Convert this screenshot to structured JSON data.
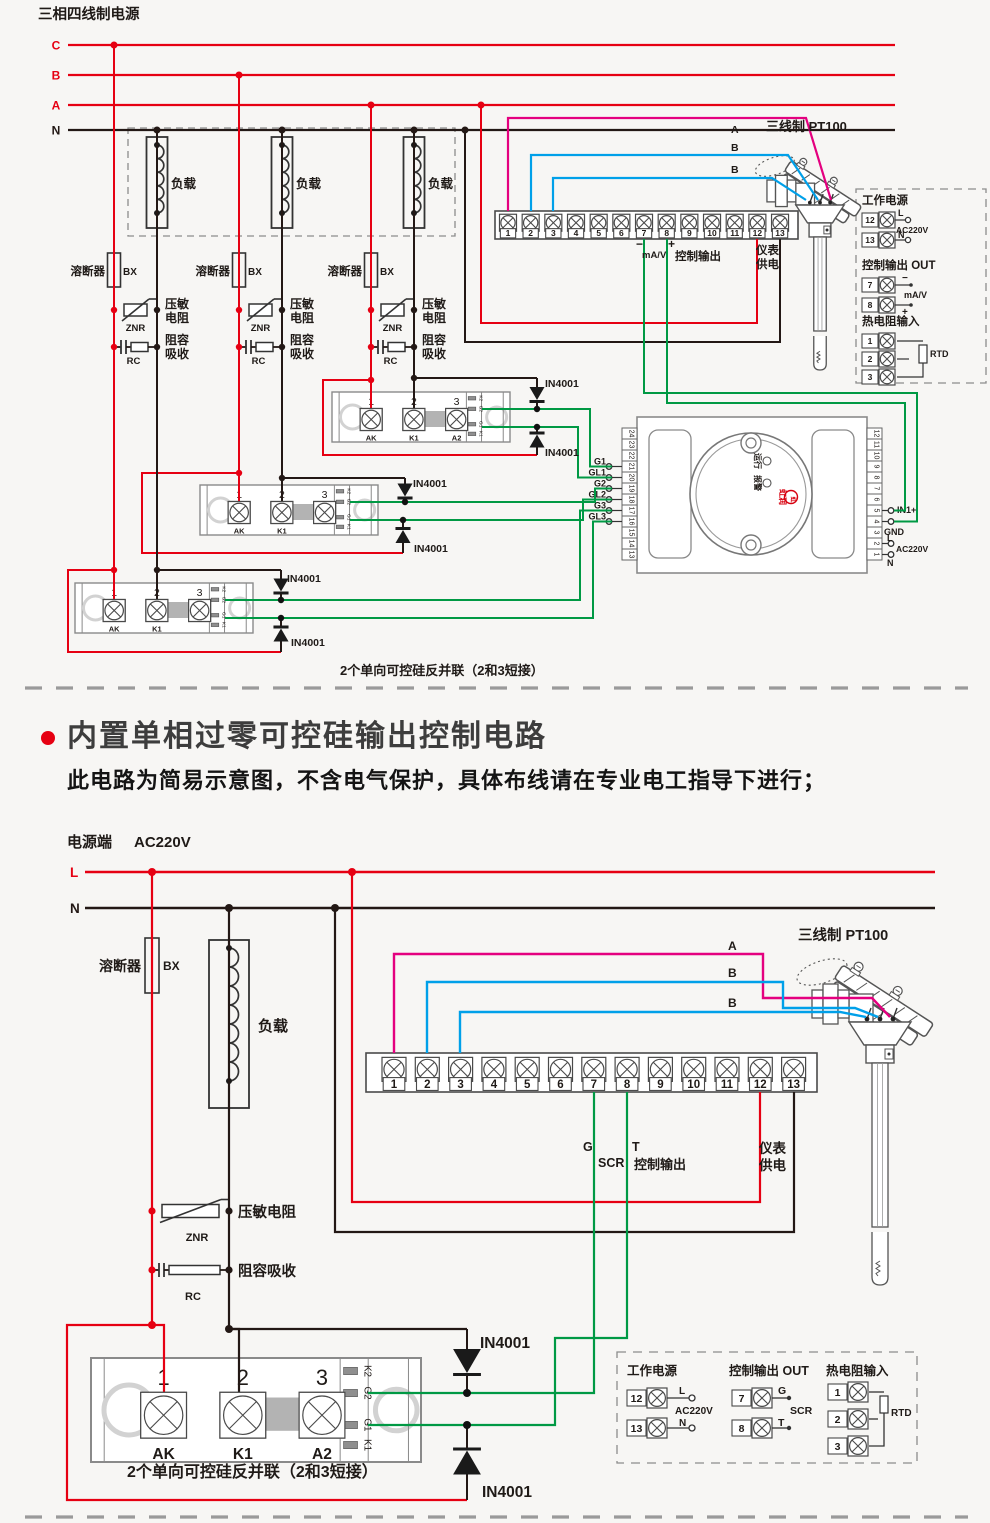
{
  "colors": {
    "red": "#e60012",
    "black": "#231815",
    "green": "#009944",
    "magenta": "#e4007f",
    "blue": "#00a0e9",
    "outline": "#555555",
    "gray": "#8c8c8c",
    "bar": "#b3b3b3",
    "bg": "#f7f6f4",
    "logo_red": "#d7000f",
    "text": "#1f1a17"
  },
  "top": {
    "title": "三相四线制电源",
    "phases": [
      "C",
      "B",
      "A",
      "N"
    ],
    "load": "负载",
    "fuse": "溶断器",
    "fuse_code": "BX",
    "varistor": "压敏电阻",
    "varistor_code": "ZNR",
    "rc": "阻容吸收",
    "rc_code": "RC",
    "diode": "IN4001",
    "block_terminals": [
      "1",
      "2",
      "3",
      "4",
      "5",
      "6",
      "7",
      "8",
      "9",
      "10",
      "11",
      "12",
      "13"
    ],
    "block_minus": "−",
    "block_mav": "mA/V",
    "block_plus": "+",
    "block_ctrl": "控制输出",
    "block_meter": [
      "仪表",
      "供电"
    ],
    "sensor": "三线制 PT100",
    "sensor_wires": [
      "A",
      "B",
      "B"
    ],
    "gates": [
      "G1",
      "GL1",
      "G2",
      "GL2",
      "G3",
      "GL3"
    ],
    "module": {
      "nums": [
        "1",
        "2",
        "3"
      ],
      "names": [
        "AK",
        "K1",
        "A2"
      ],
      "strip": [
        "K2",
        "G2",
        "G1",
        "K1"
      ]
    },
    "controller": {
      "left": [
        "24",
        "23",
        "22",
        "21",
        "20",
        "19",
        "18",
        "17",
        "16",
        "15",
        "14",
        "13"
      ],
      "right": [
        "12",
        "11",
        "10",
        "9",
        "8",
        "7",
        "6",
        "5",
        "4",
        "3",
        "2",
        "1"
      ],
      "in1": "IN1+",
      "gnd": "GND",
      "l": "L",
      "ac": "AC220V",
      "n": "N",
      "run": "运行",
      "alarm": "报警",
      "logo": "虹润"
    },
    "panel": {
      "power_title": "工作电源",
      "power_nums": [
        "12",
        "13"
      ],
      "power_l": "L",
      "power_n": "N",
      "power_ac": "AC220V",
      "out_title": "控制输出 OUT",
      "out_nums": [
        "7",
        "8"
      ],
      "out_a": "−",
      "out_b": "+",
      "out_mid": "mA/V",
      "rtd_title": "热电阻输入",
      "rtd_nums": [
        "1",
        "2",
        "3"
      ],
      "rtd": "RTD"
    },
    "caption": "2个单向可控硅反并联（2和3短接）"
  },
  "section": {
    "heading": "内置单相过零可控硅输出控制电路",
    "note": "此电路为简易示意图，不含电气保护，具体布线请在专业电工指导下进行；"
  },
  "bottom": {
    "power": "电源端",
    "voltage": "AC220V",
    "lines": [
      "L",
      "N"
    ],
    "fuse": "溶断器",
    "fuse_code": "BX",
    "load": "负载",
    "varistor": "压敏电阻",
    "varistor_code": "ZNR",
    "rc": "阻容吸收",
    "rc_code": "RC",
    "diode": "IN4001",
    "block_terminals": [
      "1",
      "2",
      "3",
      "4",
      "5",
      "6",
      "7",
      "8",
      "9",
      "10",
      "11",
      "12",
      "13"
    ],
    "block_g": "G",
    "block_scr": "SCR",
    "block_t": "T",
    "block_ctrl": "控制输出",
    "block_meter": [
      "仪表",
      "供电"
    ],
    "sensor": "三线制 PT100",
    "sensor_wires": [
      "A",
      "B",
      "B"
    ],
    "module": {
      "nums": [
        "1",
        "2",
        "3"
      ],
      "names": [
        "AK",
        "K1",
        "A2"
      ],
      "strip": [
        "K2",
        "G2",
        "G1",
        "K1"
      ]
    },
    "panel": {
      "power_title": "工作电源",
      "power_nums": [
        "12",
        "13"
      ],
      "power_l": "L",
      "power_n": "N",
      "power_ac": "AC220V",
      "out_title": "控制输出 OUT",
      "out_nums": [
        "7",
        "8"
      ],
      "out_a": "G",
      "out_b": "T",
      "out_mid": "SCR",
      "rtd_title": "热电阻输入",
      "rtd_nums": [
        "1",
        "2",
        "3"
      ],
      "rtd": "RTD"
    },
    "caption": "2个单向可控硅反并联（2和3短接）"
  }
}
